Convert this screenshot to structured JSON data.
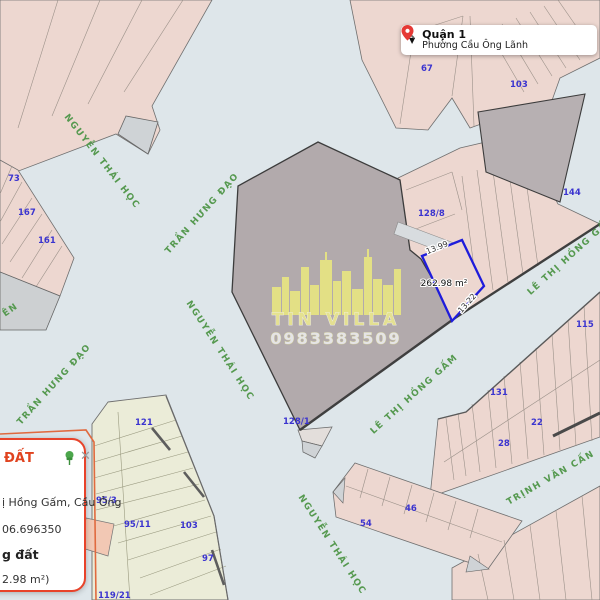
{
  "search": {
    "district": "Quận 1",
    "ward": "Phường Cầu Ông Lãnh"
  },
  "watermark": {
    "name": "TIN VILLA",
    "phone": "0983383509"
  },
  "highlight": {
    "area_label": "262.98 m²",
    "dim_top": "13.99",
    "dim_side": "13.22"
  },
  "streets": [
    {
      "name": "NGUYỄN THÁI HỌC"
    },
    {
      "name": "TRẦN HƯNG ĐẠO"
    },
    {
      "name": "TRẦN HƯNG ĐẠO"
    },
    {
      "name": "NGUYỄN THÁI HỌC"
    },
    {
      "name": "NGUYỄN THÁI HỌC"
    },
    {
      "name": "LÊ THỊ HỒNG GẤM"
    },
    {
      "name": "LÊ THỊ HỒNG GẤM"
    },
    {
      "name": "TRỊNH VĂN CẤN"
    },
    {
      "name": "ÊN"
    }
  ],
  "parcels": [
    {
      "label": "73"
    },
    {
      "label": "167"
    },
    {
      "label": "161"
    },
    {
      "label": "67"
    },
    {
      "label": "103"
    },
    {
      "label": "144"
    },
    {
      "label": "128/8"
    },
    {
      "label": "128/1"
    },
    {
      "label": "115"
    },
    {
      "label": "131"
    },
    {
      "label": "22"
    },
    {
      "label": "28"
    },
    {
      "label": "121"
    },
    {
      "label": "95/3"
    },
    {
      "label": "95/11"
    },
    {
      "label": "103"
    },
    {
      "label": "97"
    },
    {
      "label": "119/21"
    },
    {
      "label": "54"
    },
    {
      "label": "46"
    }
  ],
  "panel": {
    "title_fragment": "ĐẤT",
    "address_fragment": "ị Hồng Gấm, Cầu Ông",
    "coordinate_fragment": "06.696350",
    "bold_fragment": "g đất",
    "area_fragment": "2.98 m²)"
  },
  "colors": {
    "street_bg": "#dee6ea",
    "parcel_pink": "#edd7d0",
    "parcel_gray": "#b2aaac",
    "parcel_yellow": "#ebecd8",
    "highlight_blue": "#1f1cdb",
    "number_blue": "#3b34cf",
    "street_green": "#55994f",
    "boundary_orange": "#e06a3f",
    "panel_accent": "#e8432a",
    "watermark_yellow": "#ecea7f"
  }
}
